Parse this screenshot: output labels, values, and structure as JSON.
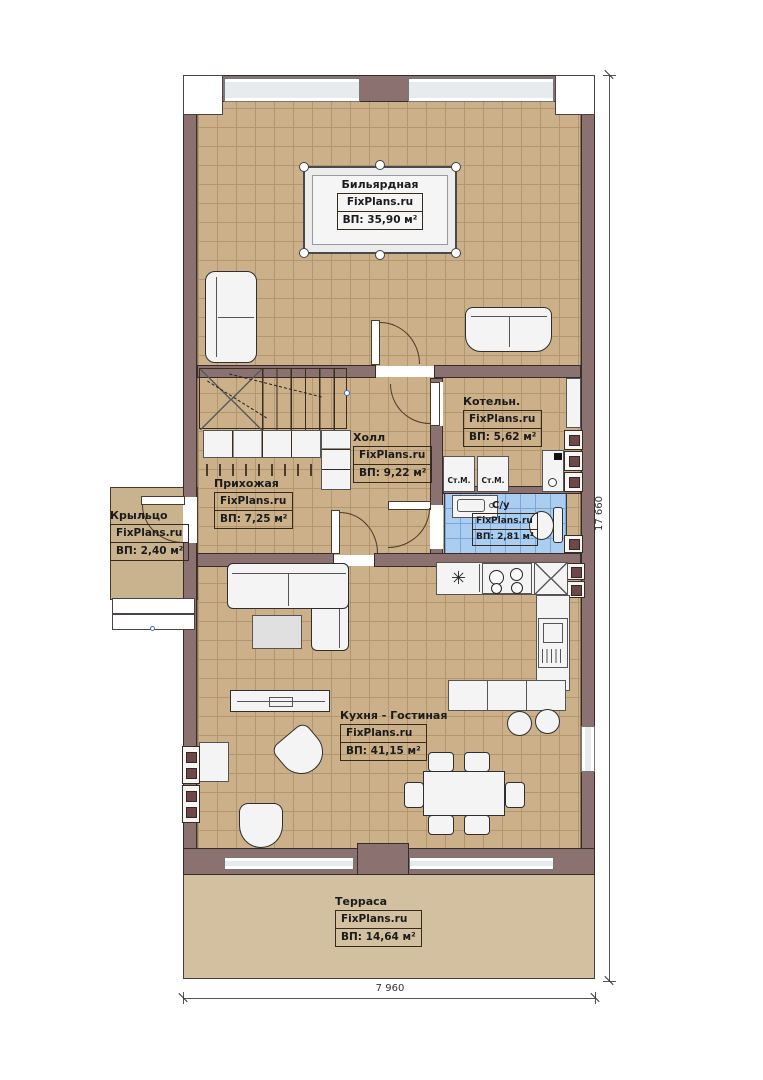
{
  "brand": "FixPlans.ru",
  "rooms": {
    "billiard": {
      "name": "Бильярдная",
      "area": "ВП: 35,90 м²"
    },
    "boiler": {
      "name": "Котельн.",
      "area": "ВП: 5,62 м²"
    },
    "hall": {
      "name": "Холл",
      "area": "ВП: 9,22 м²"
    },
    "entry": {
      "name": "Прихожая",
      "area": "ВП: 7,25 м²"
    },
    "porch": {
      "name": "Крыльцо",
      "area": "ВП: 2,40 м²"
    },
    "bath": {
      "name": "С/у",
      "area": "ВП: 2,81 м²"
    },
    "kitchen": {
      "name": "Кухня - Гостиная",
      "area": "ВП: 41,15 м²"
    },
    "terrace": {
      "name": "Терраса",
      "area": "ВП: 14,64 м²"
    }
  },
  "fixtures": {
    "washing_machine": "Ст.М."
  },
  "icons": {
    "sink": "✳"
  },
  "dimensions": {
    "vertical": "17 660",
    "horizontal": "7 960"
  },
  "colors": {
    "wall": "#8b7170",
    "floor_tile": "#cbb08a",
    "tile_grid": "#b2976e",
    "bath_tile": "#aacdf0",
    "terrace": "#d2c0a0",
    "line": "#4a3b2a"
  }
}
